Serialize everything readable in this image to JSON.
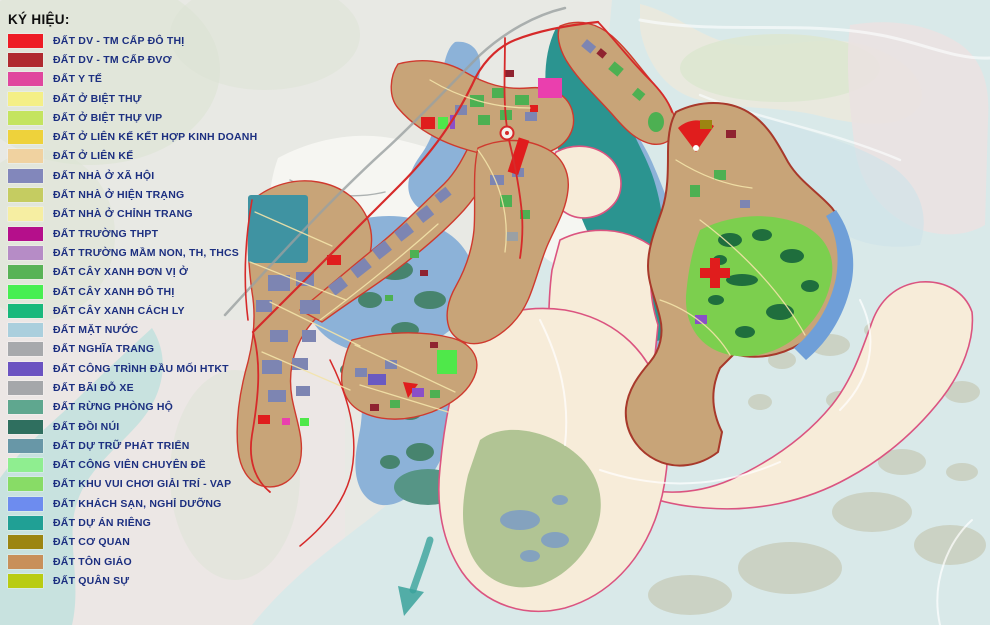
{
  "legend": {
    "title": "KÝ HIỆU:",
    "text_color": "#1c2f80",
    "items": [
      {
        "label": "ĐẤT DV - TM CẤP ĐÔ THỊ",
        "color": "#ee1c25"
      },
      {
        "label": "ĐẤT DV - TM CẤP ĐVƠ",
        "color": "#b02a30"
      },
      {
        "label": "ĐẤT Y TẾ",
        "color": "#e0479e"
      },
      {
        "label": "ĐẤT Ở BIỆT THỰ",
        "color": "#f4ef86"
      },
      {
        "label": "ĐẤT Ở BIỆT THỰ VIP",
        "color": "#c4e45f"
      },
      {
        "label": "ĐẤT Ở LIÊN KẾ KẾT HỢP KINH DOANH",
        "color": "#eed23b"
      },
      {
        "label": "ĐẤT Ở LIÊN KẾ",
        "color": "#f0d2a0"
      },
      {
        "label": "ĐẤT NHÀ Ở XÃ HỘI",
        "color": "#8287bb"
      },
      {
        "label": "ĐẤT NHÀ Ở HIỆN TRẠNG",
        "color": "#c5cc61"
      },
      {
        "label": "ĐẤT NHÀ Ở CHỈNH TRANG",
        "color": "#f6eea2"
      },
      {
        "label": "ĐẤT TRƯỜNG THPT",
        "color": "#b50f8b"
      },
      {
        "label": "ĐẤT TRƯỜNG MẦM NON, TH, THCS",
        "color": "#b68cc6"
      },
      {
        "label": "ĐẤT CÂY XANH ĐƠN VỊ Ở",
        "color": "#58b356"
      },
      {
        "label": "ĐẤT CÂY XANH ĐÔ THỊ",
        "color": "#47ef51"
      },
      {
        "label": "ĐẤT CÂY XANH CÁCH LY",
        "color": "#17b97b"
      },
      {
        "label": "ĐẤT MẶT NƯỚC",
        "color": "#aacfdd"
      },
      {
        "label": "ĐẤT NGHĨA TRANG",
        "color": "#a7a9ac"
      },
      {
        "label": "ĐẤT CÔNG TRÌNH ĐẦU MỐI HTKT",
        "color": "#6b53c1"
      },
      {
        "label": "ĐẤT BÃI ĐỖ XE",
        "color": "#a5a7aa"
      },
      {
        "label": "ĐẤT RỪNG PHÒNG HỘ",
        "color": "#5fa78f"
      },
      {
        "label": "ĐẤT ĐỒI NÚI",
        "color": "#2f6f5f"
      },
      {
        "label": "ĐẤT DỰ TRỮ PHÁT TRIỂN",
        "color": "#6897a7"
      },
      {
        "label": "ĐẤT CÔNG VIÊN CHUYÊN ĐỀ",
        "color": "#8fee90"
      },
      {
        "label": "ĐẤT KHU VUI CHƠI GIẢI TRÍ - VAP",
        "color": "#88dc66"
      },
      {
        "label": "ĐẤT KHÁCH SẠN, NGHỈ DƯỠNG",
        "color": "#6d8cef"
      },
      {
        "label": "ĐẤT DỰ ÁN RIÊNG",
        "color": "#20a095"
      },
      {
        "label": "ĐẤT CƠ QUAN",
        "color": "#9c8511"
      },
      {
        "label": "ĐẤT TÔN GIÁO",
        "color": "#c8905a"
      },
      {
        "label": "ĐẤT QUÂN SỰ",
        "color": "#b9cc12"
      }
    ]
  },
  "map": {
    "colors": {
      "sea": "#d9e9e9",
      "land": "#e8e9e4",
      "planning_water": "#8cb2d8",
      "lake": "#2b9490",
      "sand": "#f7ecd9",
      "sand_outline": "#db5480",
      "urban": "#c8a478",
      "park_green": "#7ccf4e",
      "boundary_red": "#d62a2a"
    }
  }
}
